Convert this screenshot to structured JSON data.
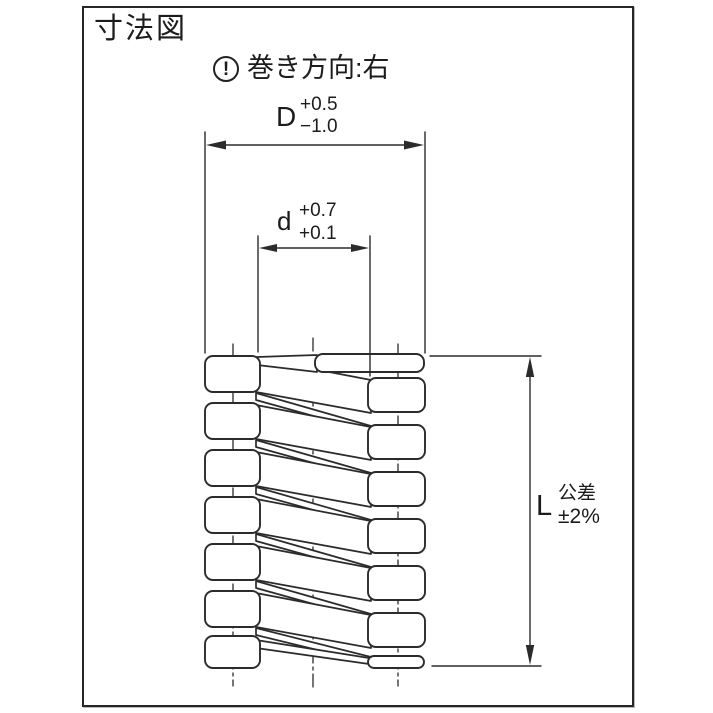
{
  "title": "寸法図",
  "note": {
    "icon_glyph": "!",
    "text": "巻き方向:右"
  },
  "dims": {
    "outer_diameter": {
      "label": "D",
      "tol_upper": "+0.5",
      "tol_lower": "−1.0"
    },
    "inner_diameter": {
      "label": "d",
      "tol_upper": "+0.7",
      "tol_lower": "+0.1"
    },
    "free_length": {
      "label": "L",
      "tol_upper": "公差",
      "tol_lower": "±2%"
    }
  },
  "colors": {
    "line": "#2b2b2b",
    "frame_border": "#262626",
    "background": "#ffffff"
  }
}
